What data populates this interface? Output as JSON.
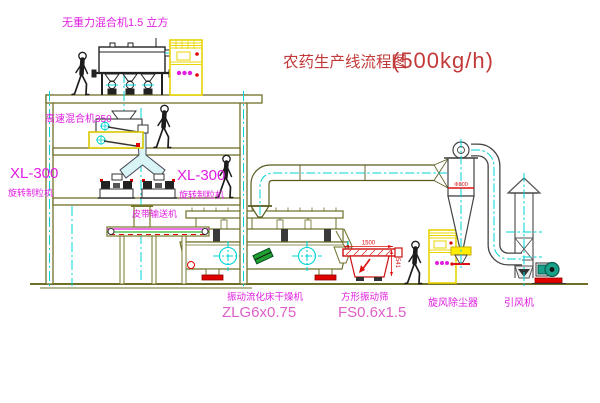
{
  "title": {
    "text": "农药生产线流程图",
    "capacity": "(500kg/h)"
  },
  "labels": {
    "gravity_free_mixer": "无重力混合机1.5 立方",
    "high_speed_mixer": "高速混合机350",
    "granulator_left_model": "XL-300",
    "granulator_left_name": "旋转制粒机",
    "granulator_center_model": "XL-300",
    "granulator_center_name": "旋转制粒机",
    "belt_conveyor": "皮带输送机",
    "dryer_name": "振动流化床干燥机",
    "dryer_model": "ZLG6x0.75",
    "sieve_name": "方形振动筛",
    "sieve_model": "FS0.6x1.5",
    "cyclone": "旋风除尘器",
    "fan": "引风机"
  },
  "dimensions": {
    "sieve_length": "1500",
    "sieve_height": "541",
    "cyclone_mark": "Φ800"
  },
  "colors": {
    "title_red": "#c23a3a",
    "label_magenta": "#e01de0",
    "model_pink": "#de5fc8",
    "dimension_red": "#dd1111",
    "structure_olive": "#6f6f2a",
    "machine_dark": "#2a2a2a",
    "centerline_cyan": "#00d4d4",
    "cabinet_yellow": "#e8d400",
    "accent_red": "#ee0000",
    "fan_teal": "#18a089",
    "detail_green": "#1fa030",
    "background": "#ffffff"
  }
}
